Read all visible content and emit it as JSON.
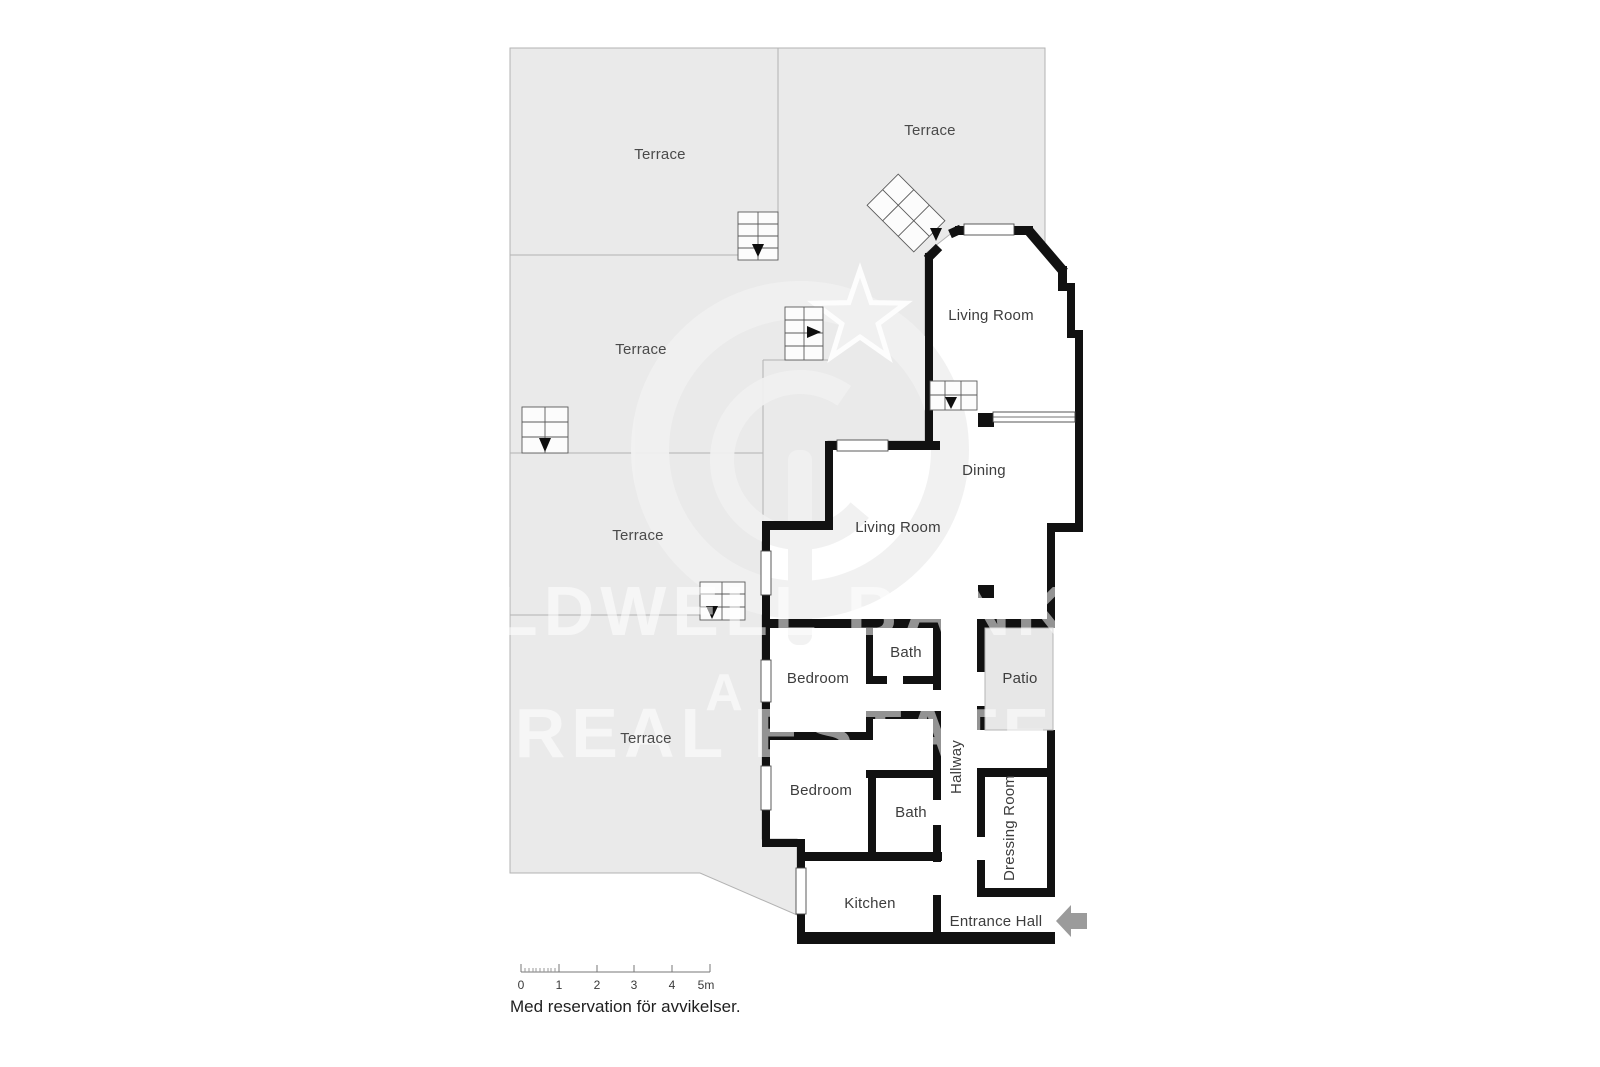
{
  "labels": {
    "terraces": [
      "Terrace",
      "Terrace",
      "Terrace",
      "Terrace",
      "Terrace"
    ],
    "rooms": {
      "living_room_upper": "Living Room",
      "living_room_lower": "Living Room",
      "dining": "Dining",
      "bedroom_1": "Bedroom",
      "bath_1": "Bath",
      "bedroom_2": "Bedroom",
      "bath_2": "Bath",
      "hallway": "Hallway",
      "patio": "Patio",
      "dressing_room": "Dressing Room",
      "kitchen": "Kitchen",
      "entrance_hall": "Entrance Hall"
    }
  },
  "watermark": {
    "line_1": "COLDWELL BANKER",
    "line_2": "A",
    "line_3": "REAL ESTATE",
    "logo": "coldwell-banker-cb-star-logo"
  },
  "scale_bar": {
    "tick_labels": [
      "0",
      "1",
      "2",
      "3",
      "4",
      "5m"
    ]
  },
  "disclaimer": "Med reservation för avvikelser.",
  "colors": {
    "terrace_fill": "#eaeaea",
    "terrace_border": "#b3b3b3",
    "wall": "#111111",
    "patio_fill": "#e7e7e7",
    "watermark_logo": "#f1f1f1",
    "entrance_arrow": "#9b9b9b"
  }
}
